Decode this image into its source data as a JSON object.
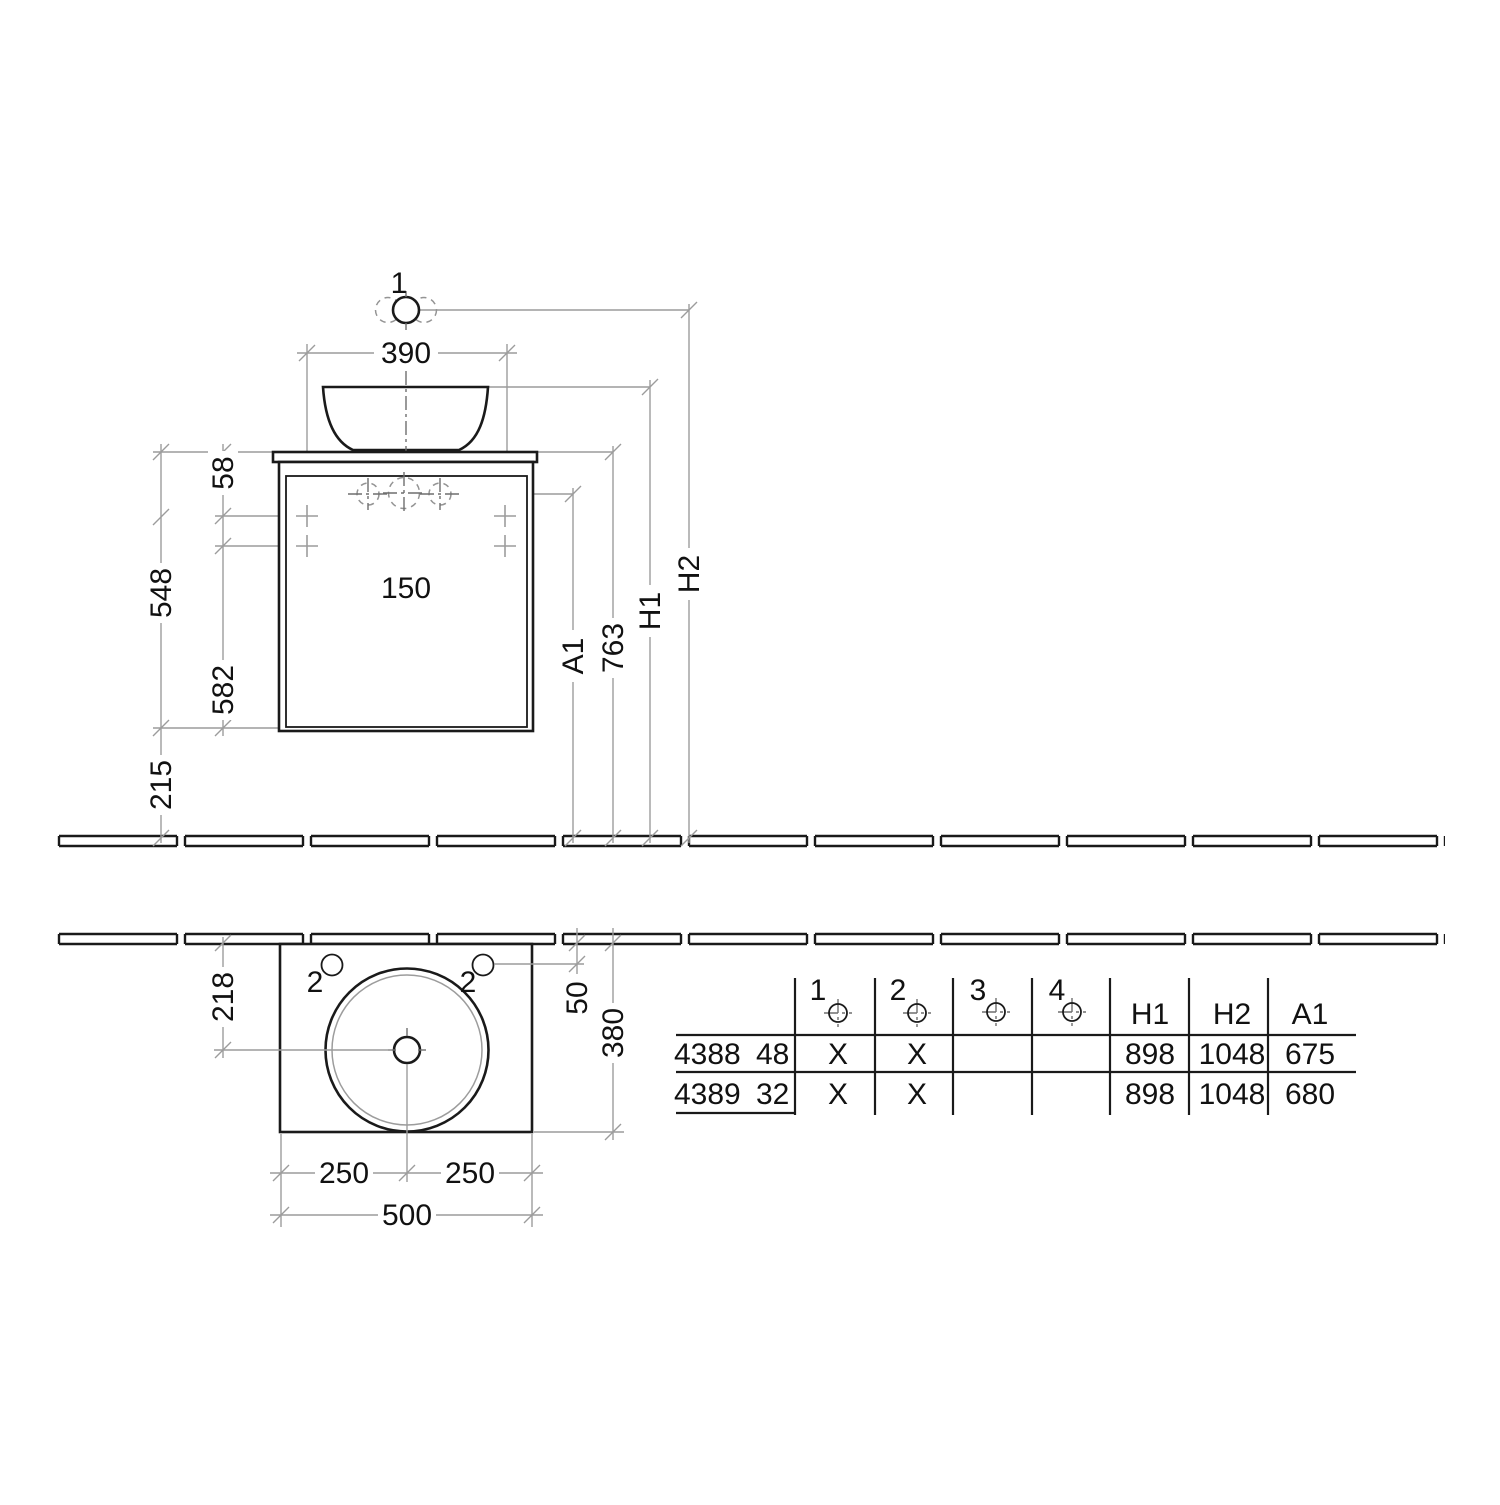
{
  "front_view": {
    "tap_position_label": "1",
    "basin_width": "390",
    "tap_hole_spacing": "150",
    "dim_counter_to_hole": "58",
    "dim_hole_to_bottom": "548",
    "dim_cabinet_height": "582",
    "dim_floor_clearance": "215",
    "dim_763": "763",
    "label_a1": "A1",
    "label_h1": "H1",
    "label_h2": "H2"
  },
  "plan_view": {
    "dim_depth_to_drain": "218",
    "left_hole_label": "2",
    "right_hole_label": "2",
    "dim_hole_offset": "50",
    "dim_depth_total": "380",
    "dim_half_left": "250",
    "dim_half_right": "250",
    "dim_width_total": "500"
  },
  "table": {
    "col_1": "1",
    "col_2": "2",
    "col_3": "3",
    "col_4": "4",
    "col_h1": "H1",
    "col_h2": "H2",
    "col_a1": "A1",
    "rows": [
      {
        "model": "4388",
        "variant": "48",
        "hole1": "X",
        "hole2": "X",
        "hole3": "",
        "hole4": "",
        "h1": "898",
        "h2": "1048",
        "a1": "675"
      },
      {
        "model": "4389",
        "variant": "32",
        "hole1": "X",
        "hole2": "X",
        "hole3": "",
        "hole4": "",
        "h1": "898",
        "h2": "1048",
        "a1": "680"
      }
    ]
  }
}
